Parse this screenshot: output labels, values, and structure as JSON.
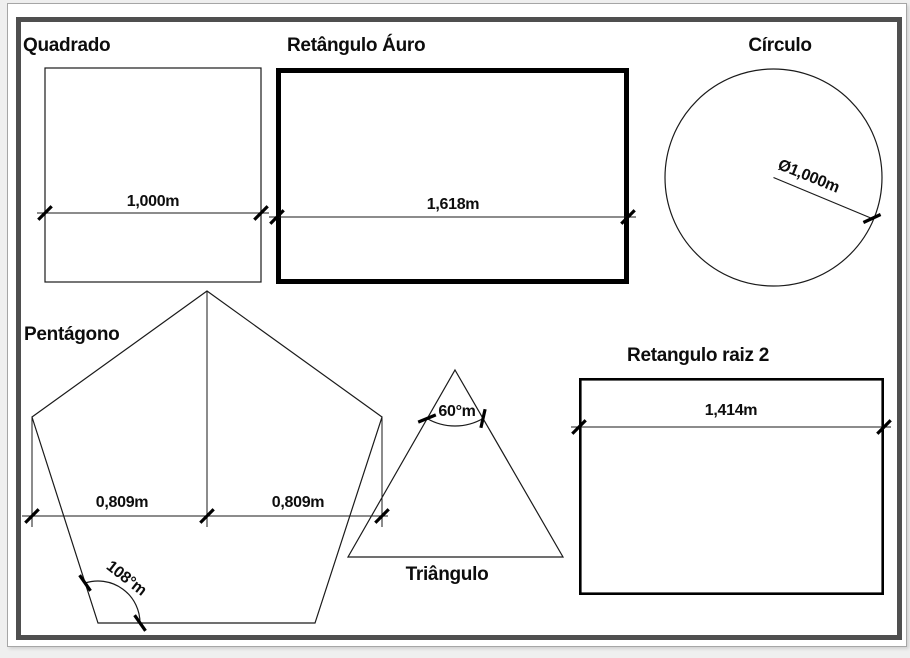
{
  "window": {
    "background": "#ffffff",
    "page_background": "#efefef",
    "frame_color": "#4f4f4f",
    "line_color": "#1a1a1a"
  },
  "shapes": {
    "square": {
      "title": "Quadrado",
      "width_label": "1,000m"
    },
    "golden_rectangle": {
      "title": "Retângulo Áuro",
      "width_label": "1,618m"
    },
    "circle": {
      "title": "Círculo",
      "diameter_label": "Ø1,000m"
    },
    "pentagon": {
      "title": "Pentágono",
      "left_half_label": "0,809m",
      "right_half_label": "0,809m",
      "angle_label": "108°m"
    },
    "triangle": {
      "title": "Triângulo",
      "angle_label": "60°m"
    },
    "root2_rectangle": {
      "title": "Retangulo raiz 2",
      "width_label": "1,414m"
    }
  }
}
